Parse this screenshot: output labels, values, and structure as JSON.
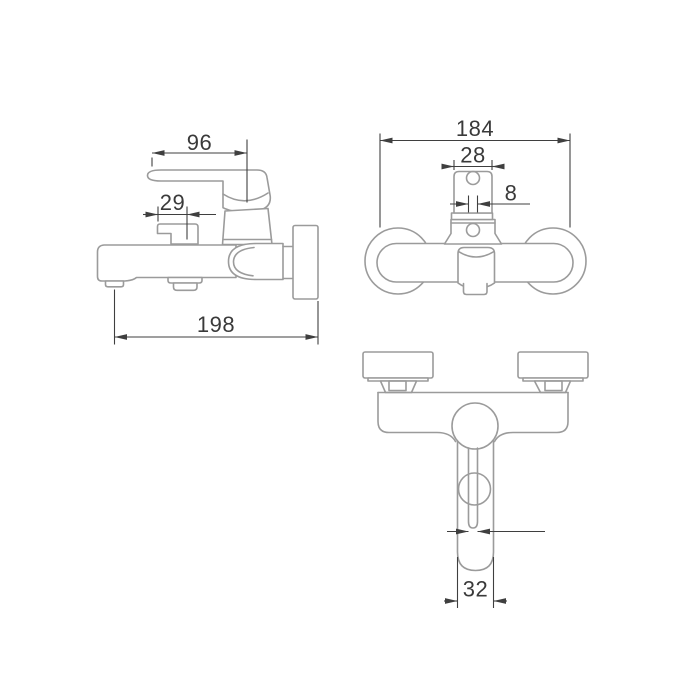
{
  "drawing": {
    "type": "technical-dimension-drawing",
    "subject": "wall-mounted bath/shower mixer faucet, three orthographic views",
    "units_note": "",
    "views": {
      "side": {
        "label": "side view",
        "dimensions": {
          "d96": "96",
          "d29": "29",
          "d198": "198"
        }
      },
      "front": {
        "label": "front view",
        "dimensions": {
          "d184": "184",
          "d28": "28",
          "d8": "8"
        }
      },
      "bottom": {
        "label": "bottom view",
        "dimensions": {
          "d32": "32"
        }
      }
    },
    "colors": {
      "background": "#ffffff",
      "outline": "#9b9b9b",
      "dimension": "#3f3f3f",
      "text": "#3a3a3a"
    }
  }
}
